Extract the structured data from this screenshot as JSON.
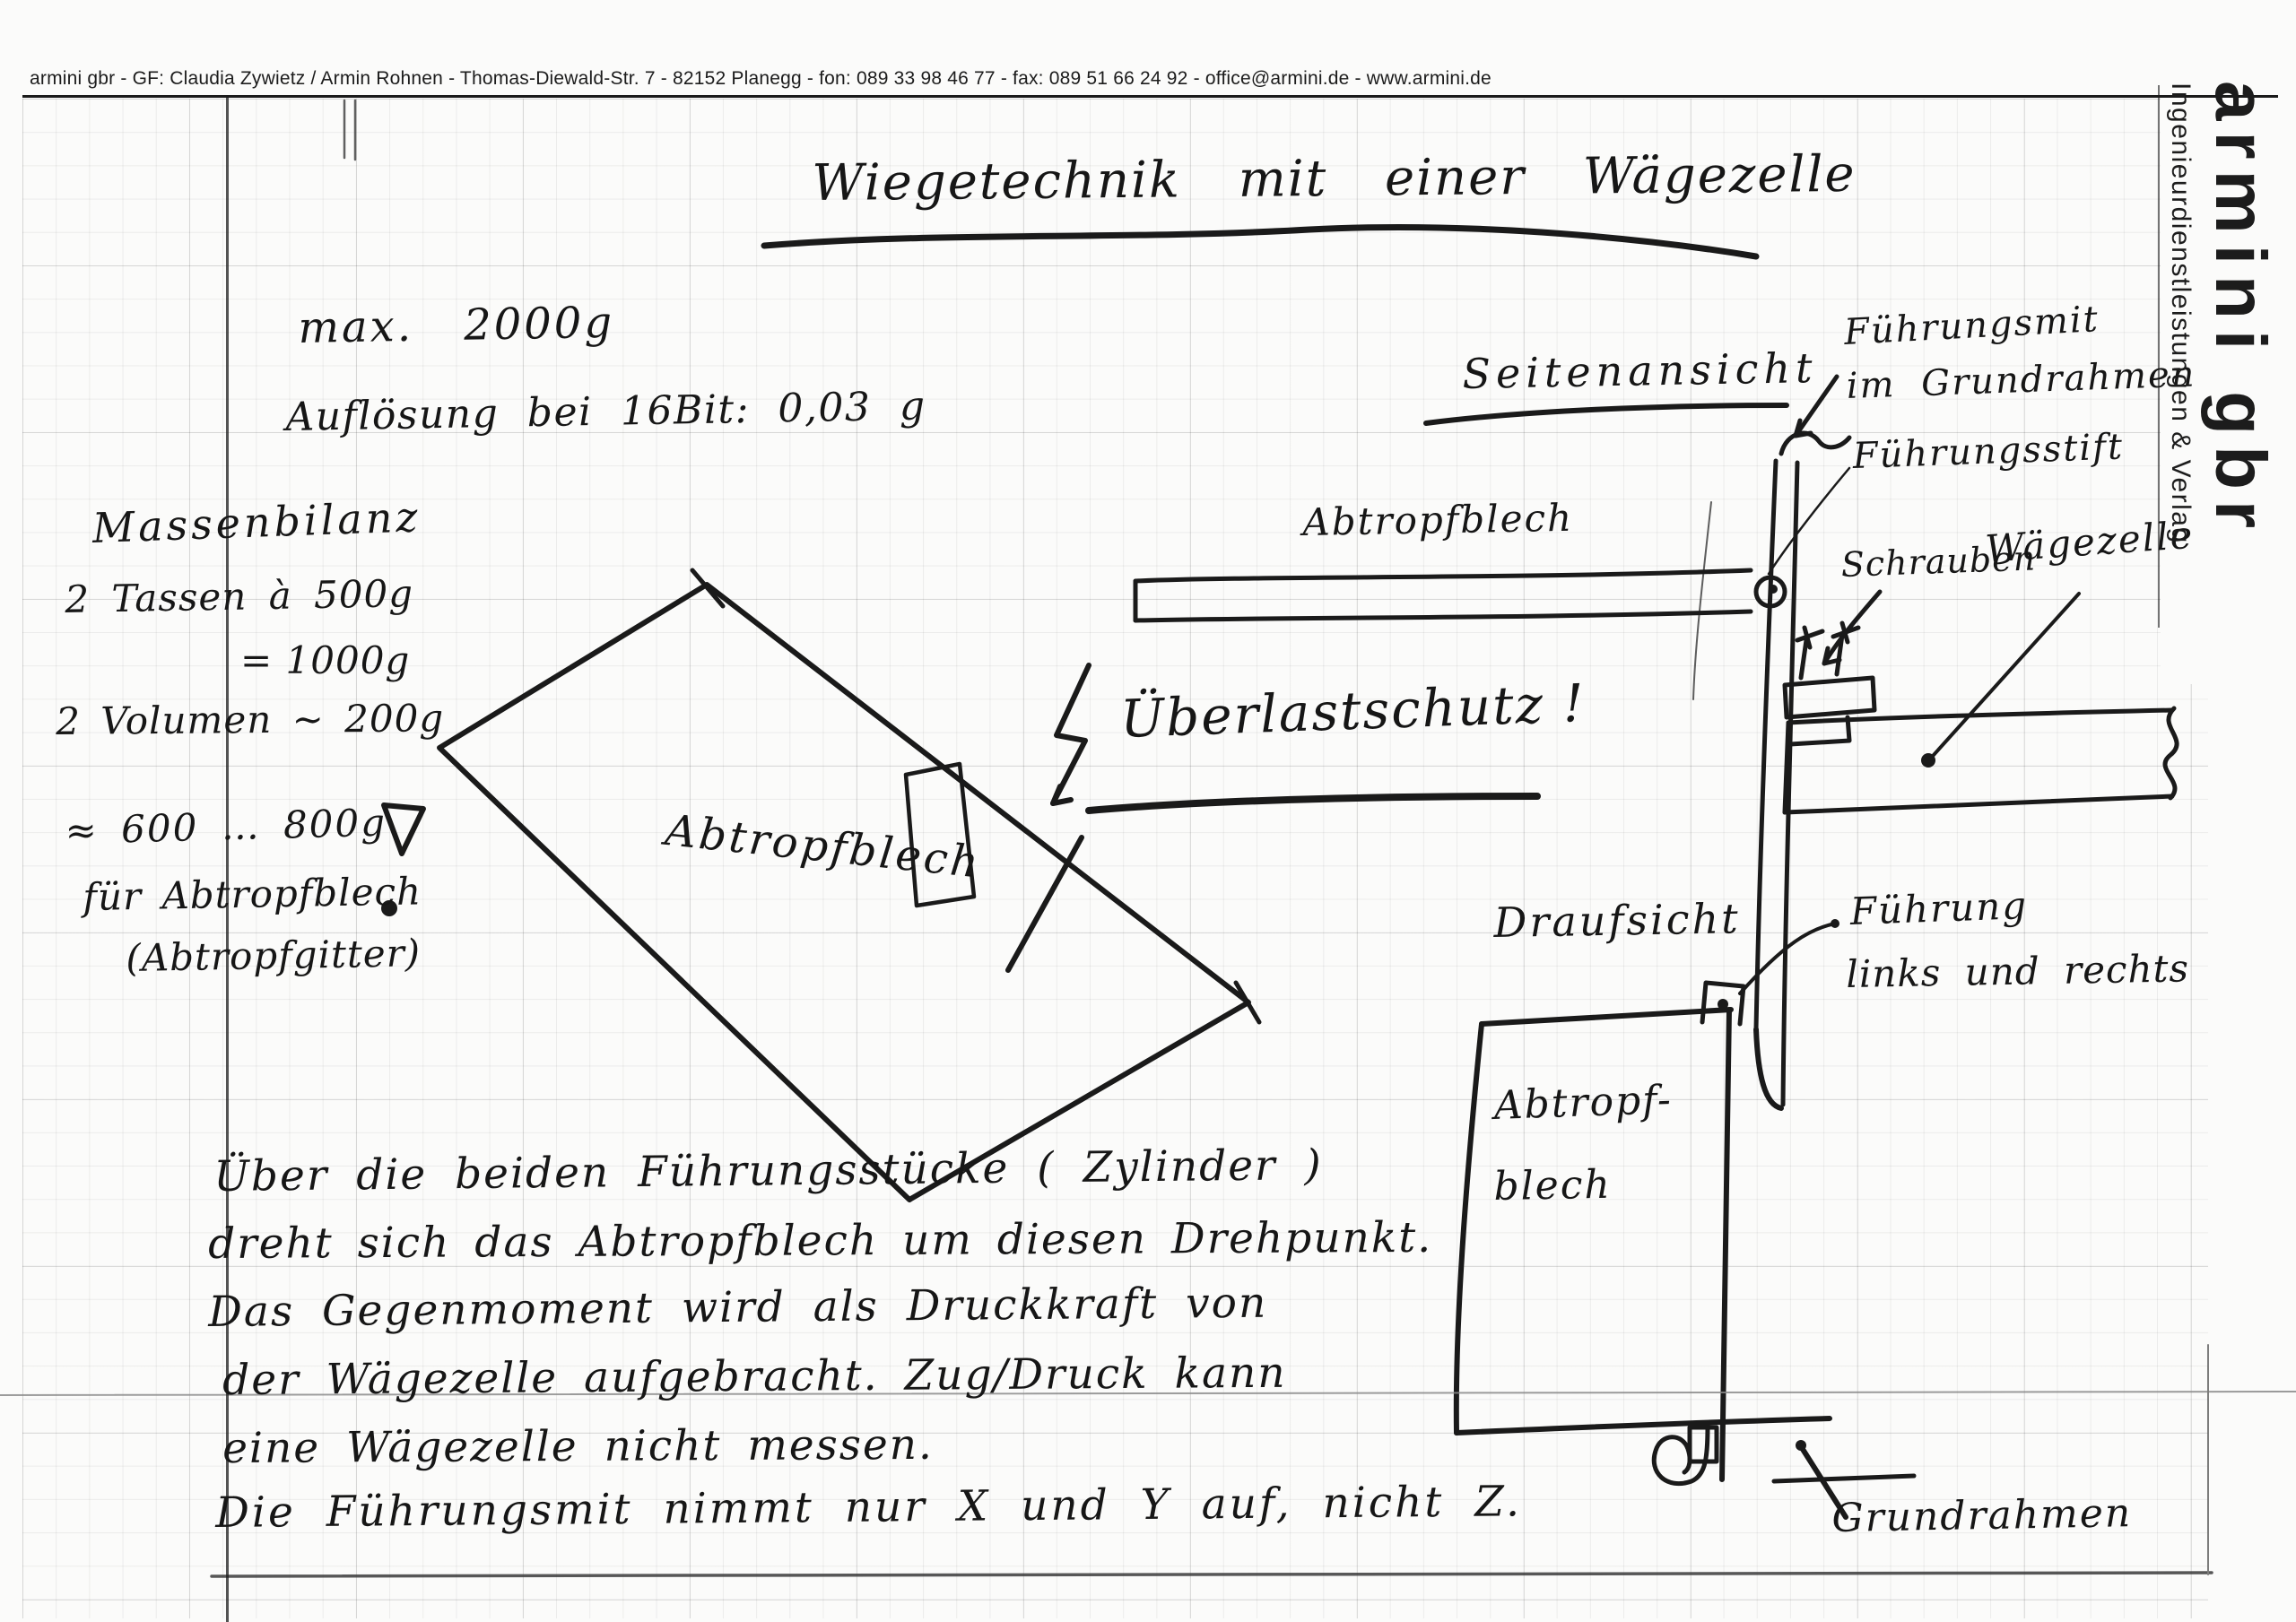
{
  "letterhead": {
    "contact_line": "armini gbr - GF: Claudia Zywietz / Armin Rohnen - Thomas-Diewald-Str. 7 - 82152 Planegg - fon: 089 33 98 46 77 - fax: 089 51 66 24 92 - office@armini.de - www.armini.de",
    "brand": "armini gbr",
    "tagline": "Ingenieurdienstleistungen & Verlag"
  },
  "title": "Wiegetechnik mit einer Wägezelle",
  "specs": {
    "max_load": "max. 2000g",
    "resolution": "Auflösung bei 16Bit: 0,03 g"
  },
  "mass_balance": {
    "heading": "Massenbilanz",
    "cups": "2 Tassen à 500g",
    "cups_sum": "= 1000g",
    "volumes": "2 Volumen ~ 200g",
    "estimate": "≈ 600 … 800g",
    "for_plate": "für Abtropfblech",
    "alt_plate": "(Abtropfgitter)"
  },
  "plate_sketch": {
    "label": "Abtropfblech"
  },
  "side_view": {
    "heading": "Seitenansicht",
    "guide_unit_line1": "Führungsmit",
    "guide_unit_line2": "im Grundrahmen",
    "guide_pin": "Führungsstift",
    "plate": "Abtropfblech",
    "screws": "Schrauben",
    "load_cell": "Wägezelle",
    "overload": "Überlastschutz !"
  },
  "top_view": {
    "heading": "Draufsicht",
    "guide_line1": "Führung",
    "guide_line2": "links und rechts",
    "plate_line1": "Abtropf-",
    "plate_line2": "blech",
    "frame": "Grundrahmen"
  },
  "paragraph": {
    "line1": "Über die beiden Führungsstücke ( Zylinder )",
    "line2": "dreht sich das Abtropfblech um diesen Drehpunkt.",
    "line3": "Das Gegenmoment wird als Druckkraft von",
    "line4": "der Wägezelle aufgebracht. Zug/Druck kann",
    "line5": "eine Wägezelle nicht messen.",
    "line6": "Die Führungsmit nimmt nur X und Y auf, nicht Z."
  },
  "ink_color": "#1a1a1a"
}
